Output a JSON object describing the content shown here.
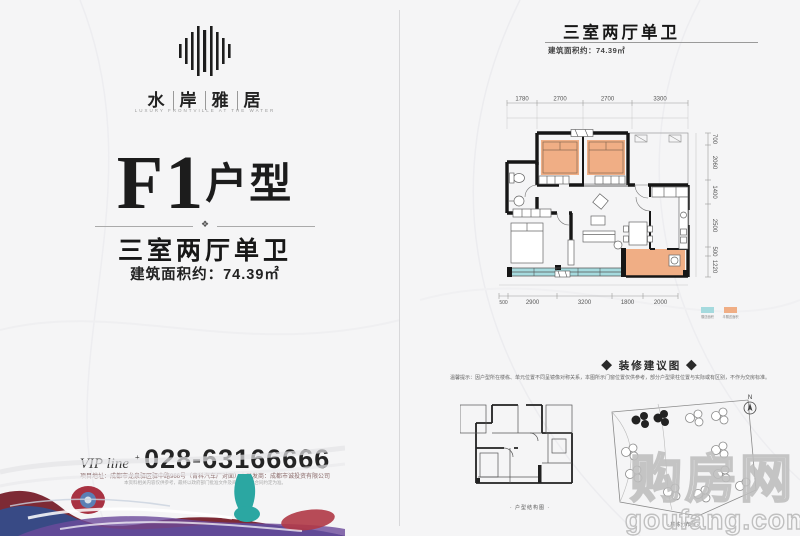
{
  "colors": {
    "accent_orange": "#f0ae85",
    "accent_teal": "#a5dade",
    "wall": "#161616"
  },
  "brand": {
    "chars": [
      "水",
      "岸",
      "雅",
      "居"
    ],
    "tagline": "LUXURY FRONTVILLE AT THE WATER"
  },
  "left_page": {
    "unit": "F1",
    "unit_suffix": "户型",
    "divider_ornament": "❖",
    "layout_title": "三室两厅单卫",
    "area_text": "建筑面积约：74.39㎡",
    "vip_label": "VIP line",
    "vip_sup": "+",
    "phone": "028-63166666",
    "address": "项目地址：成都市龙泉驿区驿中路966号（青科汽车厂对面）｜开发商：成都市诚投资有限公司",
    "fine_print": "本资料相关内容仅供参考，最终以政府部门批准文件及商品房买卖合同约定为准。"
  },
  "right_page": {
    "title": "三室两厅单卫",
    "area_text": "建筑面积约：74.39㎡",
    "plan": {
      "dims_top": [
        "1780",
        "2700",
        "2700",
        "3300"
      ],
      "dims_right": [
        "700",
        "2060",
        "1400",
        "2500",
        "500",
        "1220"
      ],
      "dims_bottom": [
        "500",
        "2900",
        "3200",
        "1800",
        "2000"
      ],
      "legend": {
        "teal_label": "赠送面积",
        "orange_label": "半赠送面积",
        "teal_color": "#a5dade",
        "orange_color": "#f0ae85"
      }
    },
    "suggestion": {
      "header": "◆ 装修建议图 ◆",
      "note": "温馨提示：因户型所在楼栋、单元位置不同呈镜像对称关系，本图所示门窗位置仅供参考，部分户型梁柱位置与实际或有区别，不作为交房标准。",
      "left_caption": "· 户型结构图 ·",
      "right_caption": "· 楼栋分布图 ·",
      "compass": "N"
    }
  },
  "watermark": {
    "cn": "购房网",
    "en": "goufang.com"
  }
}
